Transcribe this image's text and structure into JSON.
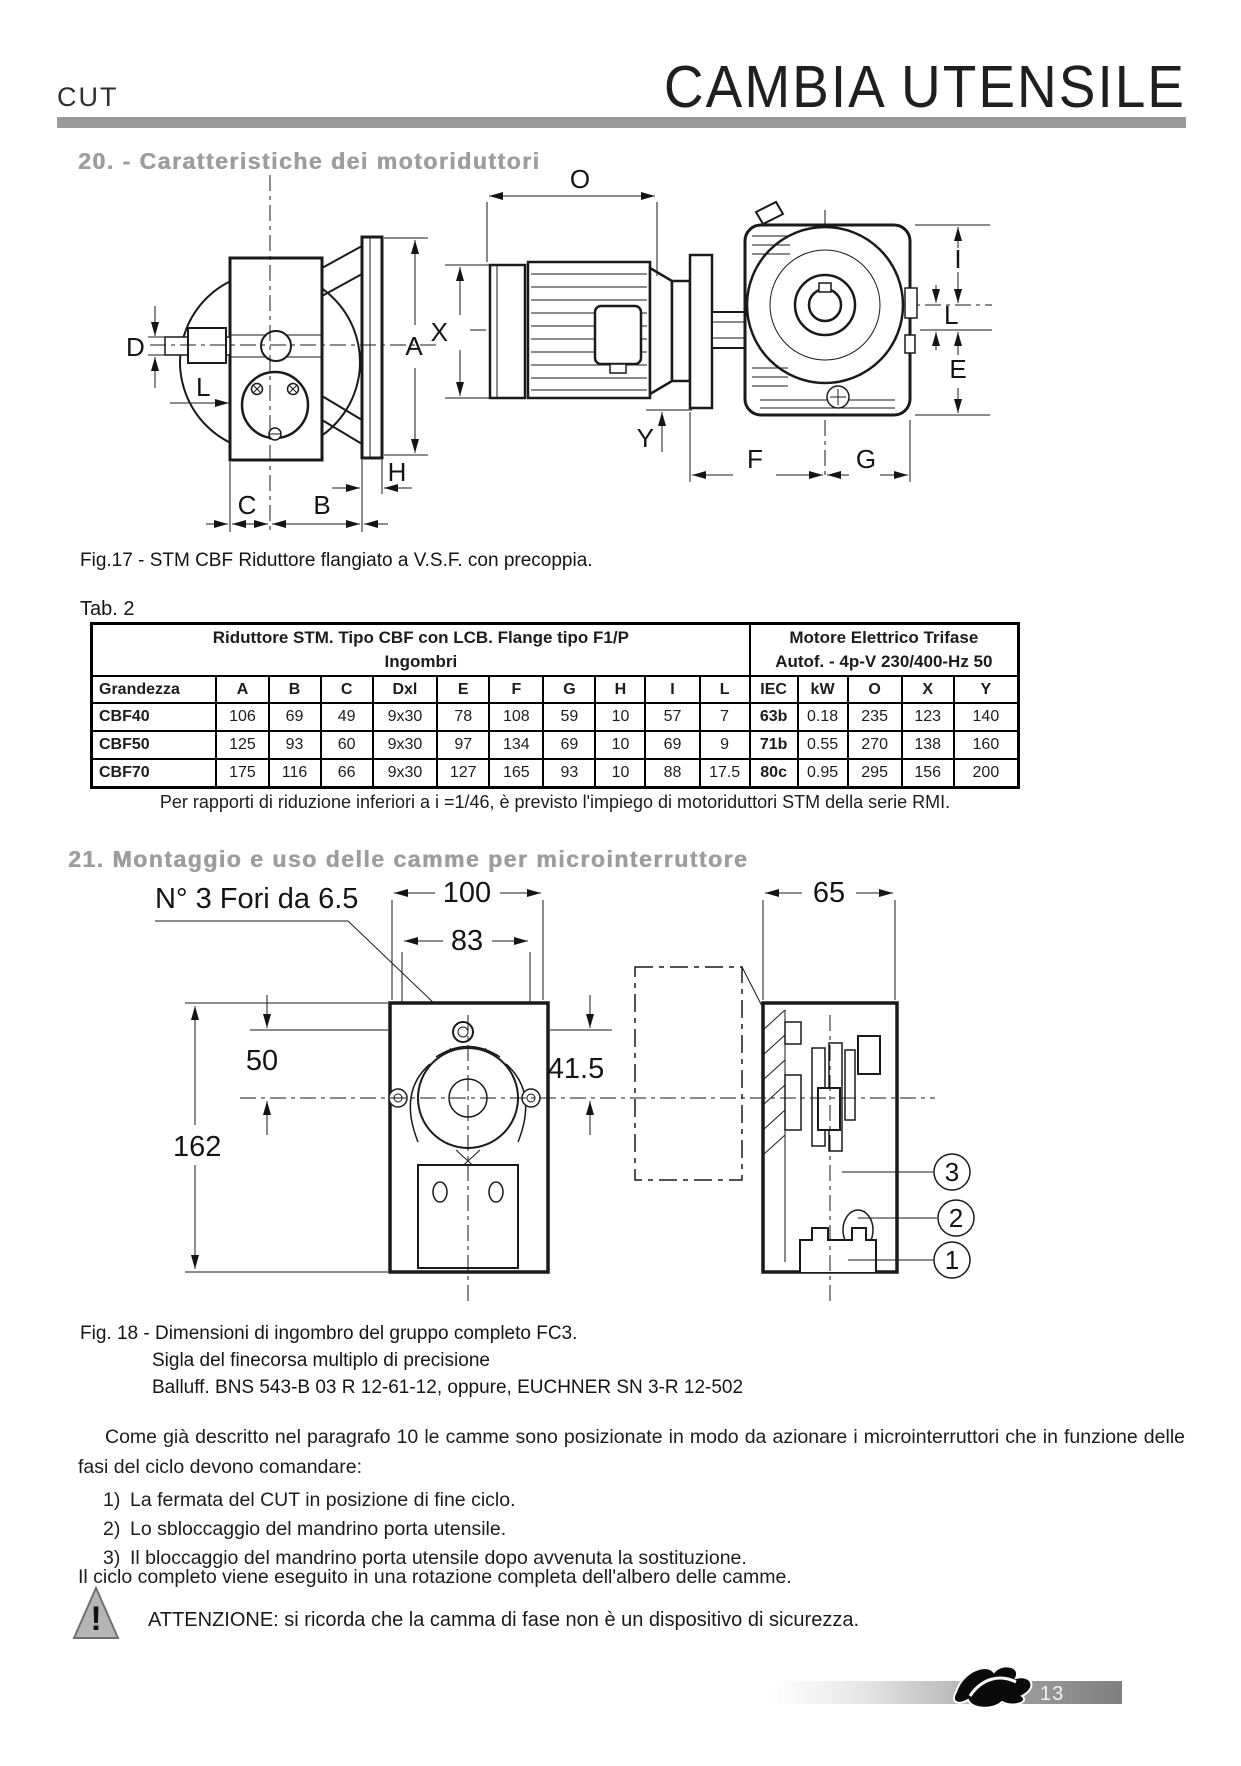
{
  "header": {
    "doc_code": "CUT",
    "title": "CAMBIA UTENSILE"
  },
  "section20": {
    "heading": "20. - Caratteristiche dei motoriduttori"
  },
  "fig17": {
    "caption": "Fig.17 - STM CBF Riduttore flangiato a V.S.F. con precoppia.",
    "labels": {
      "D": "D",
      "L": "L",
      "A": "A",
      "H": "H",
      "C": "C",
      "B": "B",
      "O": "O",
      "X": "X",
      "Y": "Y",
      "I": "I",
      "L2": "L",
      "E": "E",
      "F": "F",
      "G": "G"
    }
  },
  "table2": {
    "label": "Tab.  2",
    "group1_line1": "Riduttore  STM. Tipo CBF con LCB. Flange  tipo F1/P",
    "group1_line2": "Ingombri",
    "group2_line1": "Motore Elettrico Trifase",
    "group2_line2": "Autof. - 4p-V 230/400-Hz 50",
    "columns": [
      "Grandezza",
      "A",
      "B",
      "C",
      "Dxl",
      "E",
      "F",
      "G",
      "H",
      "I",
      "L",
      "IEC",
      "kW",
      "O",
      "X",
      "Y"
    ],
    "rows": [
      [
        "CBF40",
        "106",
        "69",
        "49",
        "9x30",
        "78",
        "108",
        "59",
        "10",
        "57",
        "7",
        "63b",
        "0.18",
        "235",
        "123",
        "140"
      ],
      [
        "CBF50",
        "125",
        "93",
        "60",
        "9x30",
        "97",
        "134",
        "69",
        "10",
        "69",
        "9",
        "71b",
        "0.55",
        "270",
        "138",
        "160"
      ],
      [
        "CBF70",
        "175",
        "116",
        "66",
        "9x30",
        "127",
        "165",
        "93",
        "10",
        "88",
        "17.5",
        "80c",
        "0.95",
        "295",
        "156",
        "200"
      ]
    ],
    "footnote": "Per rapporti di riduzione inferiori a  i =1/46, è previsto l'impiego di motoriduttori STM della serie RMI."
  },
  "section21": {
    "heading": "21. Montaggio e uso delle camme per microinterruttore"
  },
  "fig18": {
    "note_holes": "N° 3 Fori da 6.5",
    "dims": {
      "d100": "100",
      "d83": "83",
      "d65": "65",
      "d50": "50",
      "d41_5": "41.5",
      "d162": "162"
    },
    "callouts": {
      "c1": "1",
      "c2": "2",
      "c3": "3"
    },
    "caption_line1": "Fig.  18  - Dimensioni di ingombro del gruppo completo  FC3.",
    "caption_line2": "Sigla del finecorsa multiplo di precisione",
    "caption_line3": "Balluff. BNS 543-B 03 R 12-61-12, oppure, EUCHNER SN 3-R 12-502"
  },
  "body": {
    "paragraph": "Come già descritto nel paragrafo 10 le camme sono posizionate in modo da azionare i microinterruttori che in funzione delle fasi del ciclo devono comandare:",
    "items": [
      {
        "num": "1)",
        "text": "La fermata del CUT  in posizione di fine ciclo."
      },
      {
        "num": "2)",
        "text": "Lo sbloccaggio del mandrino porta utensile."
      },
      {
        "num": "3)",
        "text": "Il bloccaggio del mandrino porta utensile dopo avvenuta la sostituzione."
      }
    ],
    "closing": "Il ciclo completo viene eseguito in una rotazione completa dell'albero delle camme.",
    "warning_glyph": "!",
    "warning_text": "ATTENZIONE: si ricorda che la camma di fase non è un dispositivo di sicurezza."
  },
  "footer": {
    "page_number": "13"
  },
  "colors": {
    "header_bar": "#9a9a9a",
    "heading_text": "#9d9d9d",
    "footer_gradient_end": "#7f7f7f"
  }
}
